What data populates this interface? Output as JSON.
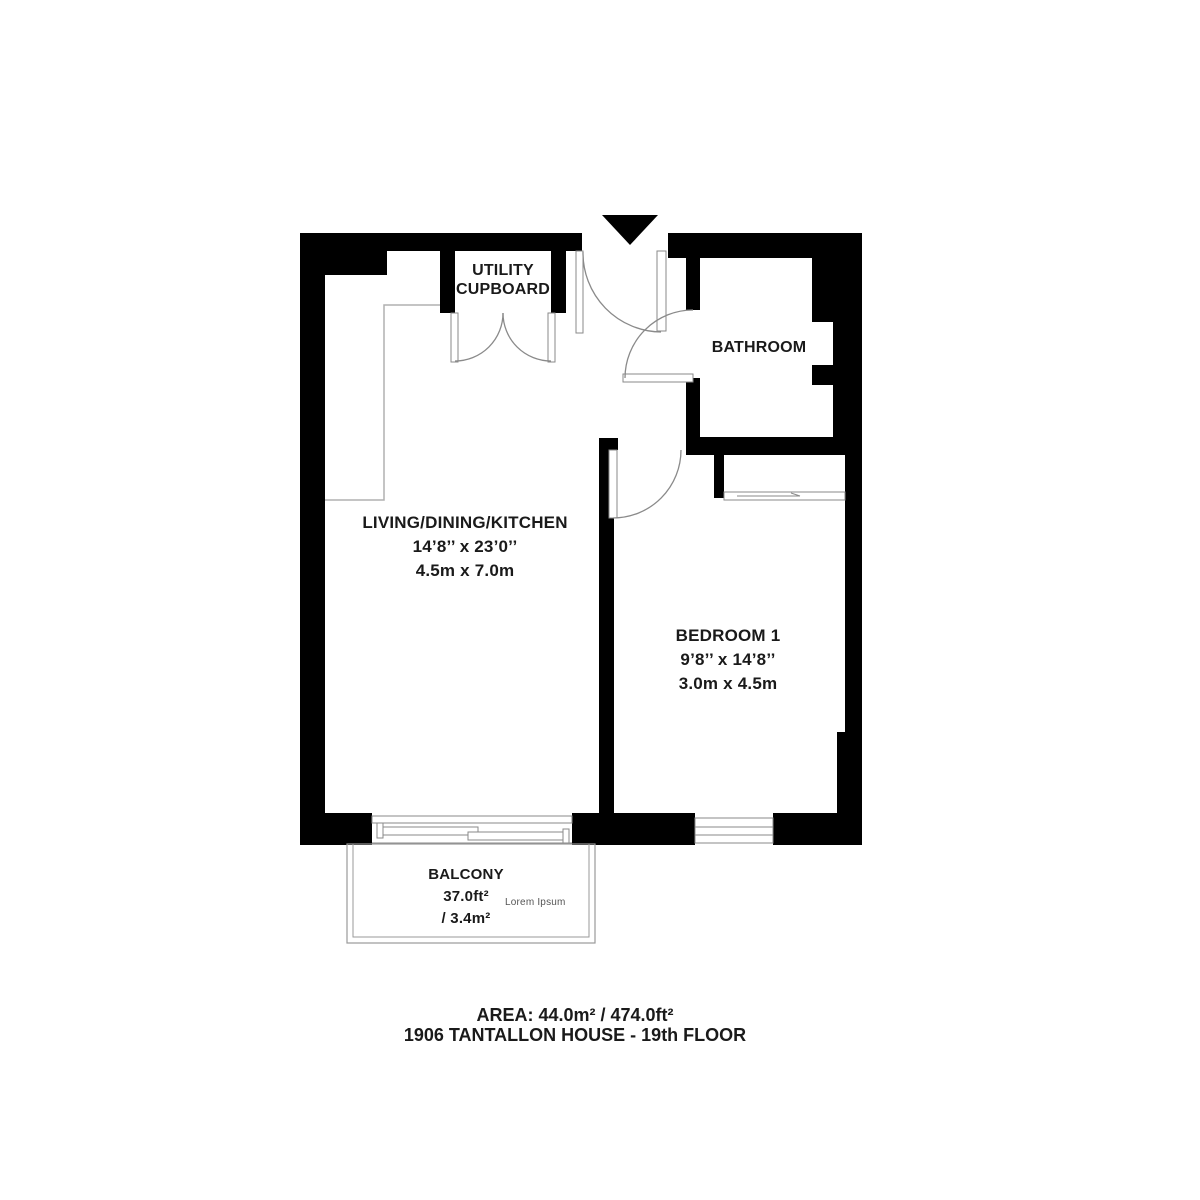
{
  "plan": {
    "rooms": {
      "utility": {
        "line1": "UTILITY",
        "line2": "CUPBOARD"
      },
      "bathroom": {
        "name": "BATHROOM"
      },
      "living": {
        "name": "LIVING/DINING/KITCHEN",
        "dim_imperial": "14’8’’ x 23’0’’",
        "dim_metric": "4.5m x 7.0m"
      },
      "bedroom": {
        "name": "BEDROOM 1",
        "dim_imperial": "9’8’’ x 14’8’’",
        "dim_metric": "3.0m x 4.5m"
      },
      "balcony": {
        "name": "BALCONY",
        "area_ft": "37.0ft²",
        "area_m": "/ 3.4m²",
        "watermark": "Lorem Ipsum"
      }
    },
    "footer": {
      "area_line": "AREA: 44.0m² / 474.0ft²",
      "address_line": "1906 TANTALLON HOUSE - 19th FLOOR"
    },
    "icons": {
      "entry": "entry-arrow"
    },
    "colors": {
      "wall": "#000000",
      "door_line": "#8a8a8a",
      "thin_line": "#b0b0b0",
      "text": "#1a1a1a",
      "watermark_text": "#555555"
    }
  }
}
